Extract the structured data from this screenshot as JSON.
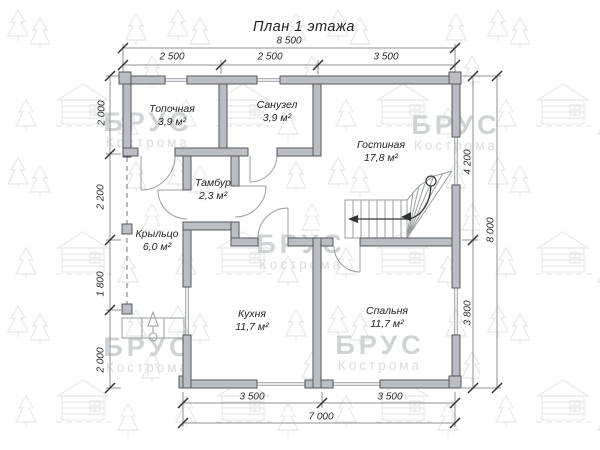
{
  "title": "План 1 этажа",
  "watermark": {
    "brand": "БРУС",
    "city": "Кострома"
  },
  "rooms": [
    {
      "name": "Топочная",
      "area": "3,9 м²"
    },
    {
      "name": "Санузел",
      "area": "3,9 м²"
    },
    {
      "name": "Гостиная",
      "area": "17,8 м²"
    },
    {
      "name": "Тамбур",
      "area": "2,3 м²"
    },
    {
      "name": "Крыльцо",
      "area": "6,0 м²"
    },
    {
      "name": "Кухня",
      "area": "11,7 м²"
    },
    {
      "name": "Спальня",
      "area": "11,7 м²"
    }
  ],
  "dimensions": {
    "top_total": "8 500",
    "top_segments": [
      "2 500",
      "2 500",
      "3 500"
    ],
    "left_segments": [
      "2 000",
      "2 200",
      "1 800",
      "2 000"
    ],
    "right_segments": [
      "4 200",
      "3 800"
    ],
    "right_total": "8 000",
    "bottom_segments": [
      "3 500",
      "3 500"
    ],
    "bottom_total": "7 000"
  },
  "colors": {
    "wall_fill": "#babec2",
    "wall_stroke": "#54575a",
    "dim_text": "#2b2b2b",
    "watermark": "#d0d3d5"
  }
}
